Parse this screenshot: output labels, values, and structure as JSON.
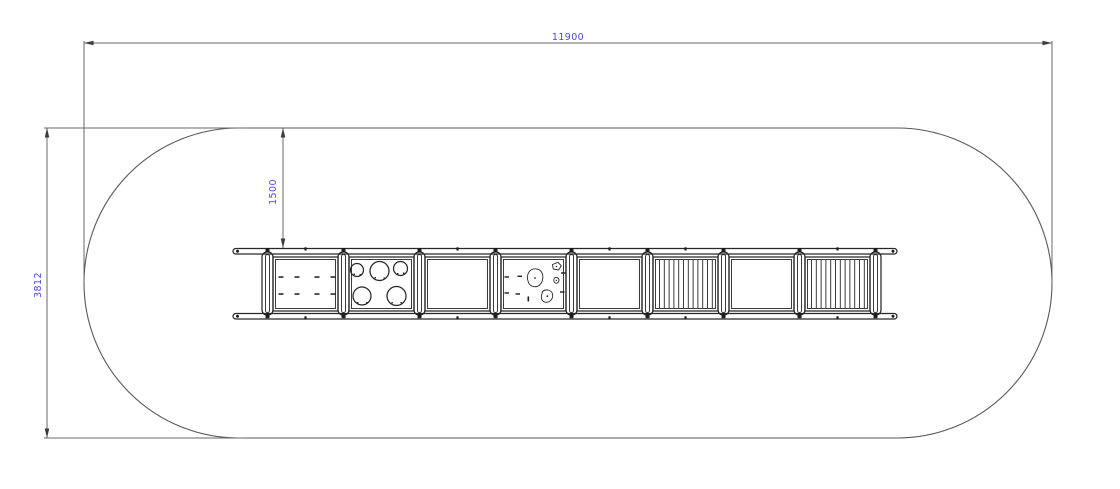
{
  "drawing": {
    "type": "technical-plan-view",
    "dimensions": {
      "overall_width_mm": {
        "label": "11900"
      },
      "overall_depth_mm": {
        "label": "3812"
      },
      "clearance_offset_mm": {
        "label": "1500"
      }
    },
    "colors": {
      "dimension_text": "#4a4ae0",
      "dimension_lines": "#6a6a6a",
      "safety_zone_outline": "#585858",
      "equipment_lines": "#272727",
      "background": "#ffffff"
    },
    "equipment": {
      "description": "overhead ladder / play structure plan view with eight panels between posts",
      "panels": [
        {
          "index": 1,
          "type": "rung-grid-panel"
        },
        {
          "index": 2,
          "type": "hole-climb-panel"
        },
        {
          "index": 3,
          "type": "open-panel"
        },
        {
          "index": 4,
          "type": "climbing-holds-panel"
        },
        {
          "index": 5,
          "type": "open-panel"
        },
        {
          "index": 6,
          "type": "vertical-bars-panel"
        },
        {
          "index": 7,
          "type": "open-panel"
        },
        {
          "index": 8,
          "type": "vertical-bars-panel"
        }
      ]
    }
  }
}
